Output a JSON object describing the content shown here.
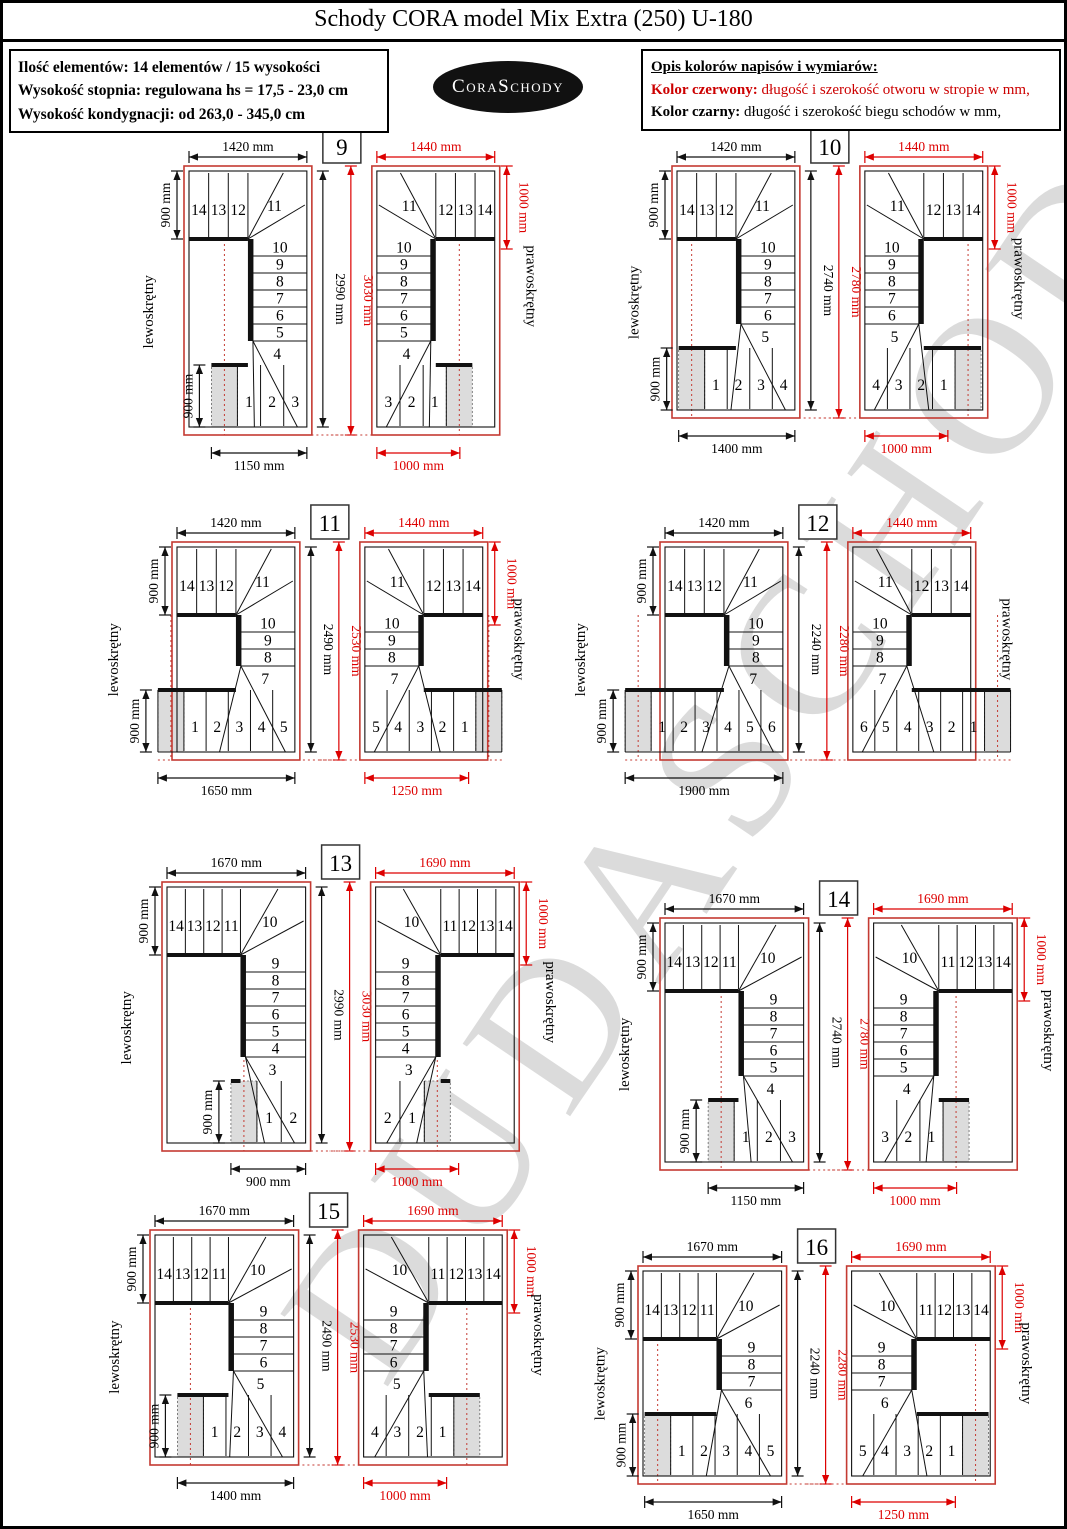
{
  "page": {
    "title": "Schody CORA model Mix Extra (250) U-180"
  },
  "info_box": {
    "lines": [
      "Ilość elementów: 14 elementów / 15 wysokości",
      "Wysokość stopnia: regulowana  hs = 17,5 - 23,0 cm",
      "Wysokość kondygnacji: od 263,0 - 345,0 cm"
    ]
  },
  "logo": {
    "text": "CoraSchody"
  },
  "legend_box": {
    "heading": "Opis kolorów napisów i wymiarów:",
    "red_label": "Kolor czerwony:",
    "red_text": " długość i szerokość otworu w stropie w mm,",
    "black_label": "Kolor czarny:",
    "black_text": " długość i szerokość biegu schodów w mm,"
  },
  "watermark": {
    "text": "DUDASCHODY"
  },
  "labels": {
    "left_turn": "lewoskrętny",
    "right_turn": "prawoskrętny",
    "dim_900": "900 mm"
  },
  "colors": {
    "dim_red": "#dd0000",
    "opening_red": "#c43a32",
    "black": "#111111",
    "shade": "#dcdcdc"
  },
  "plans": [
    {
      "number": "9",
      "dims": {
        "top_black": "1420 mm",
        "top_red": "1440 mm",
        "height_black": "2990 mm",
        "height_red": "3030 mm",
        "bottom_black": "1150 mm",
        "bottom_red": "1000 mm",
        "right_red": "1000 mm"
      },
      "mm": {
        "top": 1420,
        "height": 2990,
        "bottom": 1150,
        "bottom_red": 1000
      },
      "steps": {
        "top": [
          "14",
          "13",
          "12"
        ],
        "top_winder": "11",
        "mid": [
          "10",
          "9",
          "8",
          "7",
          "6",
          "5"
        ],
        "bottom_winder": "4",
        "bottom": [
          "1",
          "2",
          "3"
        ]
      }
    },
    {
      "number": "10",
      "dims": {
        "top_black": "1420 mm",
        "top_red": "1440 mm",
        "height_black": "2740 mm",
        "height_red": "2780 mm",
        "bottom_black": "1400 mm",
        "bottom_red": "1000 mm",
        "right_red": "1000 mm"
      },
      "mm": {
        "top": 1420,
        "height": 2740,
        "bottom": 1400,
        "bottom_red": 1000
      },
      "steps": {
        "top": [
          "14",
          "13",
          "12"
        ],
        "top_winder": "11",
        "mid": [
          "10",
          "9",
          "8",
          "7",
          "6"
        ],
        "bottom_winder": "5",
        "bottom": [
          "1",
          "2",
          "3",
          "4"
        ]
      }
    },
    {
      "number": "11",
      "dims": {
        "top_black": "1420 mm",
        "top_red": "1440 mm",
        "height_black": "2490 mm",
        "height_red": "2530 mm",
        "bottom_black": "1650 mm",
        "bottom_red": "1250 mm",
        "right_red": "1000 mm"
      },
      "mm": {
        "top": 1420,
        "height": 2490,
        "bottom": 1650,
        "bottom_red": 1250
      },
      "steps": {
        "top": [
          "14",
          "13",
          "12"
        ],
        "top_winder": "11",
        "mid": [
          "10",
          "9",
          "8"
        ],
        "bottom_winder": "7",
        "bottom": [
          "1",
          "2",
          "3",
          "4",
          "5"
        ]
      }
    },
    {
      "number": "12",
      "dims": {
        "top_black": "1420 mm",
        "top_red": "1440 mm",
        "height_black": "2240 mm",
        "height_red": "2280 mm",
        "bottom_black": "1900 mm",
        "bottom_red": null,
        "right_red": null
      },
      "mm": {
        "top": 1420,
        "height": 2240,
        "bottom": 1900,
        "bottom_red": null
      },
      "steps": {
        "top": [
          "14",
          "13",
          "12"
        ],
        "top_winder": "11",
        "mid": [
          "10",
          "9",
          "8"
        ],
        "bottom_winder": "7",
        "bottom": [
          "1",
          "2",
          "3",
          "4",
          "5",
          "6"
        ]
      }
    },
    {
      "number": "13",
      "dims": {
        "top_black": "1670 mm",
        "top_red": "1690 mm",
        "height_black": "2990 mm",
        "height_red": "3030 mm",
        "bottom_black": "900 mm",
        "bottom_red": "1000 mm",
        "right_red": "1000 mm"
      },
      "mm": {
        "top": 1670,
        "height": 2990,
        "bottom": 900,
        "bottom_red": 1000
      },
      "steps": {
        "top": [
          "14",
          "13",
          "12",
          "11"
        ],
        "top_winder": "10",
        "mid": [
          "9",
          "8",
          "7",
          "6",
          "5",
          "4"
        ],
        "bottom_winder": "3",
        "bottom": [
          "1",
          "2"
        ]
      }
    },
    {
      "number": "14",
      "dims": {
        "top_black": "1670 mm",
        "top_red": "1690 mm",
        "height_black": "2740 mm",
        "height_red": "2780 mm",
        "bottom_black": "1150 mm",
        "bottom_red": "1000 mm",
        "right_red": "1000 mm"
      },
      "mm": {
        "top": 1670,
        "height": 2740,
        "bottom": 1150,
        "bottom_red": 1000
      },
      "steps": {
        "top": [
          "14",
          "13",
          "12",
          "11"
        ],
        "top_winder": "10",
        "mid": [
          "9",
          "8",
          "7",
          "6",
          "5"
        ],
        "bottom_winder": "4",
        "bottom": [
          "1",
          "2",
          "3"
        ]
      }
    },
    {
      "number": "15",
      "dims": {
        "top_black": "1670 mm",
        "top_red": "1690 mm",
        "height_black": "2490 mm",
        "height_red": "2530 mm",
        "bottom_black": "1400 mm",
        "bottom_red": "1000 mm",
        "right_red": "1000 mm"
      },
      "mm": {
        "top": 1670,
        "height": 2490,
        "bottom": 1400,
        "bottom_red": 1000
      },
      "steps": {
        "top": [
          "14",
          "13",
          "12",
          "11"
        ],
        "top_winder": "10",
        "mid": [
          "9",
          "8",
          "7",
          "6"
        ],
        "bottom_winder": "5",
        "bottom": [
          "1",
          "2",
          "3",
          "4"
        ]
      }
    },
    {
      "number": "16",
      "dims": {
        "top_black": "1670 mm",
        "top_red": "1690 mm",
        "height_black": "2240 mm",
        "height_red": "2280 mm",
        "bottom_black": "1650 mm",
        "bottom_red": "1250 mm",
        "right_red": "1000 mm"
      },
      "mm": {
        "top": 1670,
        "height": 2240,
        "bottom": 1650,
        "bottom_red": 1250
      },
      "steps": {
        "top": [
          "14",
          "13",
          "12",
          "11"
        ],
        "top_winder": "10",
        "mid": [
          "9",
          "8",
          "7"
        ],
        "bottom_winder": "6",
        "bottom": [
          "1",
          "2",
          "3",
          "4",
          "5"
        ]
      }
    }
  ]
}
